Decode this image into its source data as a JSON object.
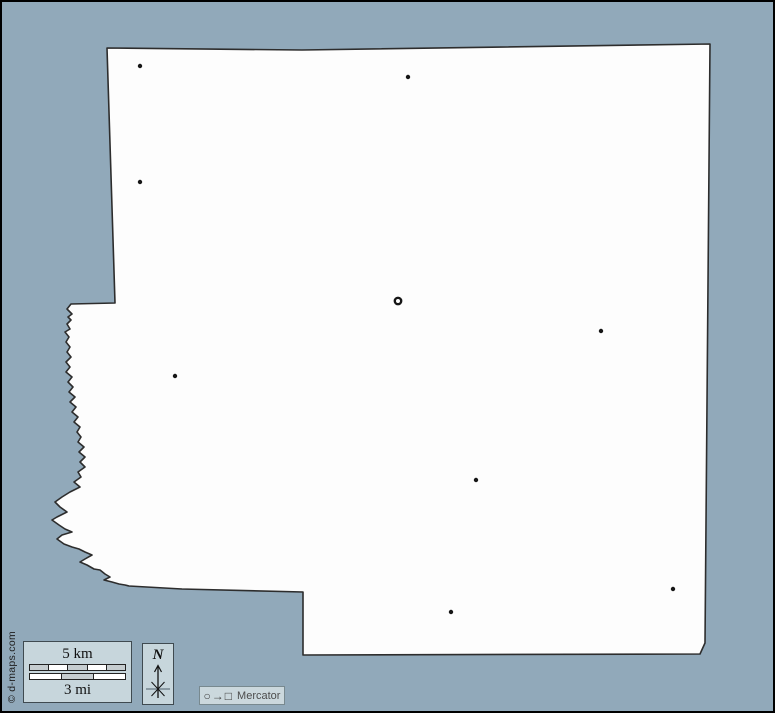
{
  "page": {
    "background_color": "#91a9ba",
    "frame_color": "#000000"
  },
  "map": {
    "region_fill": "#fdfdfd",
    "outline_color": "#2d2d2d",
    "marker_color": "#161616",
    "markers": [
      {
        "type": "ring",
        "x": 396,
        "y": 299
      },
      {
        "type": "dot",
        "x": 138,
        "y": 64
      },
      {
        "type": "dot",
        "x": 406,
        "y": 75
      },
      {
        "type": "dot",
        "x": 138,
        "y": 180
      },
      {
        "type": "dot",
        "x": 173,
        "y": 374
      },
      {
        "type": "dot",
        "x": 599,
        "y": 329
      },
      {
        "type": "dot",
        "x": 474,
        "y": 478
      },
      {
        "type": "dot",
        "x": 671,
        "y": 587
      },
      {
        "type": "dot",
        "x": 449,
        "y": 610
      }
    ]
  },
  "scale_bar": {
    "km_label": "5 km",
    "mi_label": "3 mi",
    "km_segment_colors": [
      "#c6cdd0",
      "#ffffff",
      "#c6cdd0",
      "#ffffff",
      "#c6cdd0"
    ],
    "mi_segment_colors": [
      "#ffffff",
      "#c6cdd0",
      "#ffffff"
    ]
  },
  "compass": {
    "label": "N"
  },
  "projection": {
    "icon_glyphs": "○→□",
    "label": "Mercator"
  },
  "credit": {
    "text": "© d-maps.com"
  }
}
